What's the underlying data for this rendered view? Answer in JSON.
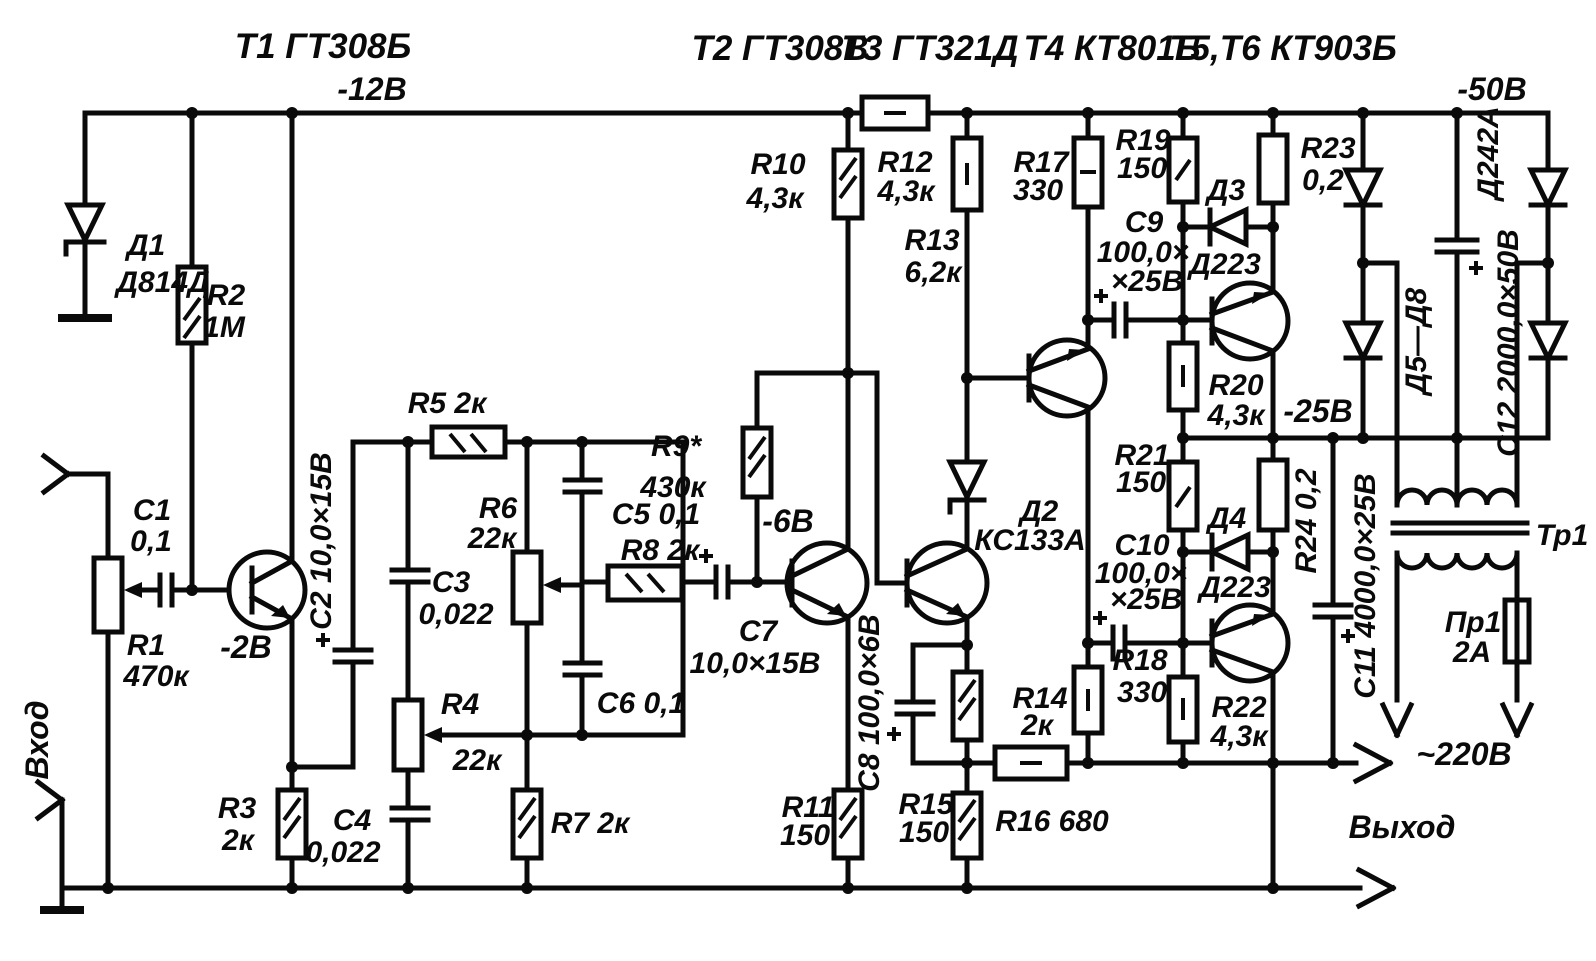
{
  "title_row": {
    "t1": "Т1 ГТ308Б",
    "v12": "-12В",
    "t2": "Т2 ГТ308В",
    "t3": "Т3 ГТ321Д",
    "t4": "Т4 КТ801Б",
    "t56": "Т5,Т6 КТ903Б",
    "v50": "-50В"
  },
  "io": {
    "input": "Вход",
    "output": "Выход",
    "mains": "~220В"
  },
  "volts": {
    "v2": "-2В",
    "v6": "-6В",
    "v25": "-25В"
  },
  "components": {
    "d1": {
      "name": "Д1",
      "type": "Д814Д"
    },
    "d2": {
      "name": "Д2",
      "type": "КС133А"
    },
    "d3": {
      "name": "Д3",
      "type": "Д223"
    },
    "d4": {
      "name": "Д4",
      "type": "Д223"
    },
    "d58": {
      "name": "Д5—Д8",
      "type": "Д242А"
    },
    "r1": {
      "name": "R1",
      "value": "470к"
    },
    "r2": {
      "name": "R2",
      "value": "1М"
    },
    "r3": {
      "name": "R3",
      "value": "2к"
    },
    "r4": {
      "name": "R4",
      "value": "22к"
    },
    "r5": {
      "label": "R5 2к"
    },
    "r6": {
      "name": "R6",
      "value": "22к"
    },
    "r7": {
      "label": "R7 2к"
    },
    "r8": {
      "label": "R8 2к"
    },
    "r9": {
      "name": "R9*",
      "value": "430к"
    },
    "r10": {
      "name": "R10",
      "value": "4,3к"
    },
    "r11": {
      "name": "R11",
      "value": "150"
    },
    "r12": {
      "name": "R12",
      "value": "4,3к"
    },
    "r13": {
      "name": "R13",
      "value": "6,2к"
    },
    "r14": {
      "name": "R14",
      "value": "2к"
    },
    "r15": {
      "name": "R15",
      "value": "150"
    },
    "r16": {
      "label": "R16 680"
    },
    "r17": {
      "name": "R17",
      "value": "330"
    },
    "r18": {
      "name": "R18",
      "value": "330"
    },
    "r19": {
      "name": "R19",
      "value": "150"
    },
    "r20": {
      "name": "R20",
      "value": "4,3к"
    },
    "r21": {
      "name": "R21",
      "value": "150"
    },
    "r22": {
      "name": "R22",
      "value": "4,3к"
    },
    "r23": {
      "name": "R23",
      "value": "0,2"
    },
    "r24": {
      "label": "R24 0,2"
    },
    "c1": {
      "name": "C1",
      "value": "0,1"
    },
    "c2": {
      "label": "C2 10,0×15В"
    },
    "c3": {
      "name": "C3",
      "value": "0,022"
    },
    "c4": {
      "name": "C4",
      "value": "0,022"
    },
    "c5": {
      "label": "C5 0,1"
    },
    "c6": {
      "label": "C6 0,1"
    },
    "c7": {
      "name": "C7",
      "value": "10,0×15В"
    },
    "c8": {
      "label": "C8 100,0×6В"
    },
    "c9": {
      "name": "C9",
      "l1": "100,0×",
      "l2": "×25В"
    },
    "c10": {
      "name": "C10",
      "l1": "100,0×",
      "l2": "×25В"
    },
    "c11": {
      "label": "С11 4000,0×25В"
    },
    "c12": {
      "label": "С12 2000,0×50В"
    },
    "pr1": {
      "name": "Пр1",
      "value": "2А"
    },
    "tr1": {
      "name": "Тр1"
    }
  }
}
